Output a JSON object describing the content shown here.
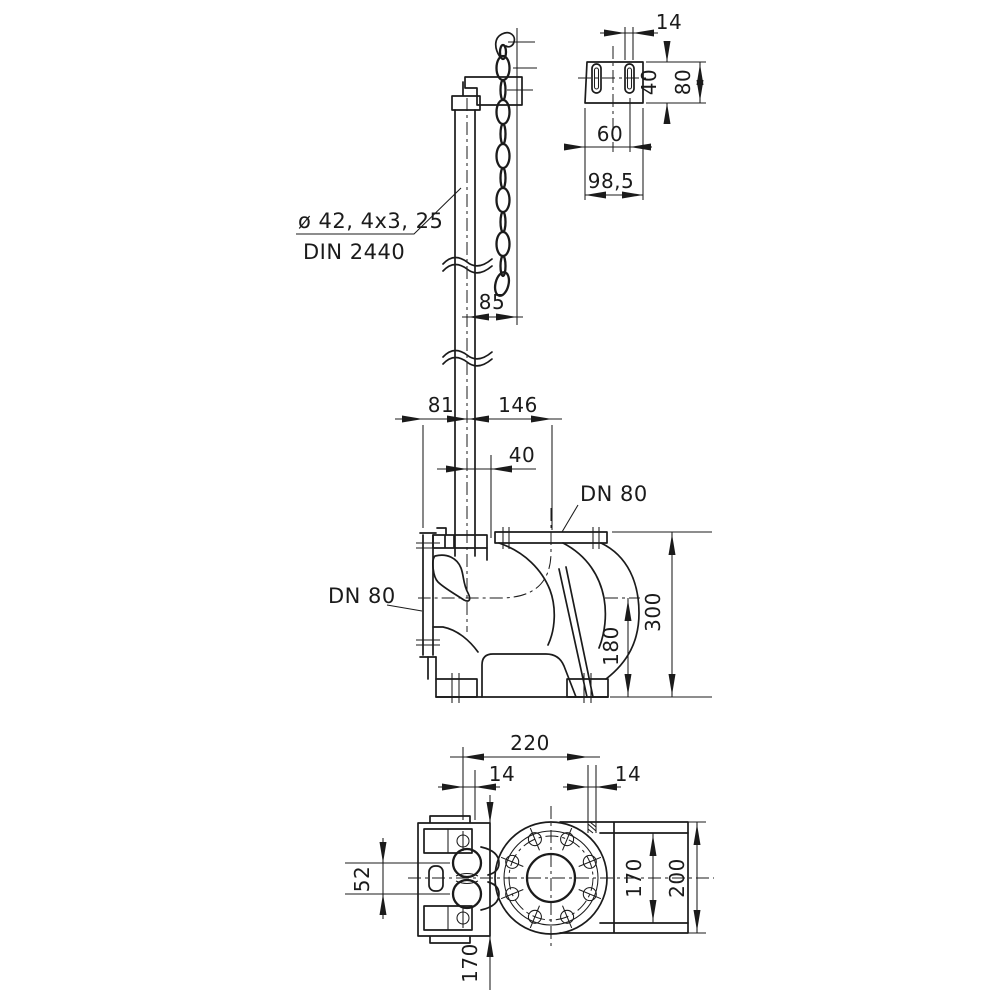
{
  "labels": {
    "pipe_spec": "ø 42, 4x3, 25",
    "pipe_standard": "DIN 2440",
    "flange_top": "DN 80",
    "flange_side": "DN 80"
  },
  "dimensions": {
    "bracket_slot_width": "14",
    "bracket_plate_height": "40",
    "bracket_height": "80",
    "bracket_hole_offset": "60",
    "bracket_depth": "98,5",
    "chain_offset": "85",
    "pipe_offset_left": "81",
    "pipe_offset_right": "146",
    "pipe_to_flange": "40",
    "outlet_height": "180",
    "total_height": "300",
    "plan_width": "220",
    "plan_hole_left": "14",
    "plan_hole_right": "14",
    "guide_hole_spacing": "52",
    "plan_depth": "170",
    "bolt_circle": "170",
    "flange_od": "200"
  }
}
